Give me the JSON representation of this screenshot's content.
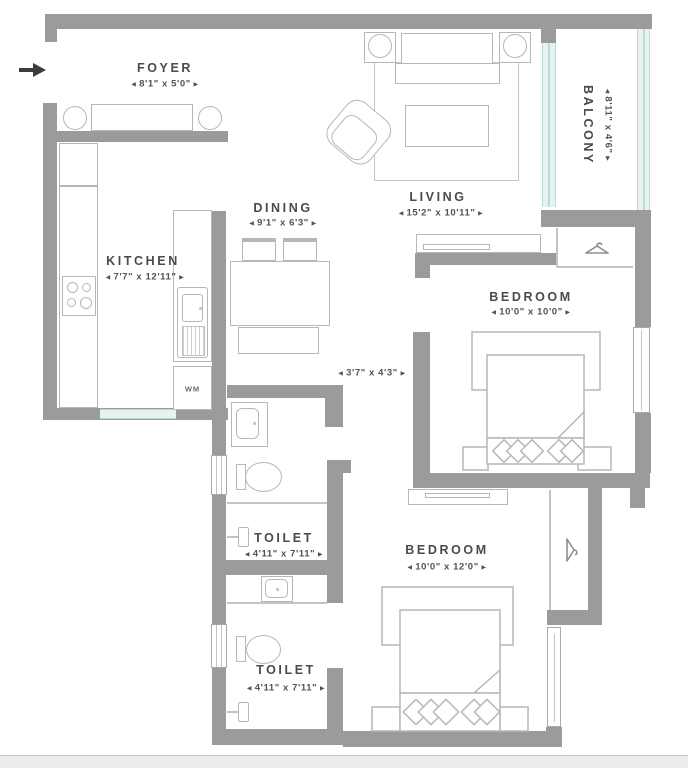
{
  "floor_plan": {
    "rooms": {
      "foyer": {
        "name": "FOYER",
        "dims": "8'1\" x 5'0\""
      },
      "kitchen": {
        "name": "KITCHEN",
        "dims": "7'7\" x 12'11\""
      },
      "dining": {
        "name": "DINING",
        "dims": "9'1\" x 6'3\""
      },
      "living": {
        "name": "LIVING",
        "dims": "15'2\" x 10'11\""
      },
      "balcony": {
        "name": "BALCONY",
        "dims": "8'11\" x 4'6\""
      },
      "bedroom1": {
        "name": "BEDROOM",
        "dims": "10'0\" x 10'0\""
      },
      "bedroom2": {
        "name": "BEDROOM",
        "dims": "10'0\" x 12'0\""
      },
      "toilet1": {
        "name": "TOILET",
        "dims": "4'11\" x 7'11\""
      },
      "toilet2": {
        "name": "TOILET",
        "dims": "4'11\" x 7'11\""
      },
      "passage": {
        "dims": "3'7\" x 4'3\""
      }
    },
    "labels": {
      "washing_machine": "WM"
    },
    "colors": {
      "wall": "#9b9b9b",
      "furniture_line": "#b7b7b7",
      "text": "#4a4a4a",
      "window_teal": "#b9dbd7"
    }
  }
}
